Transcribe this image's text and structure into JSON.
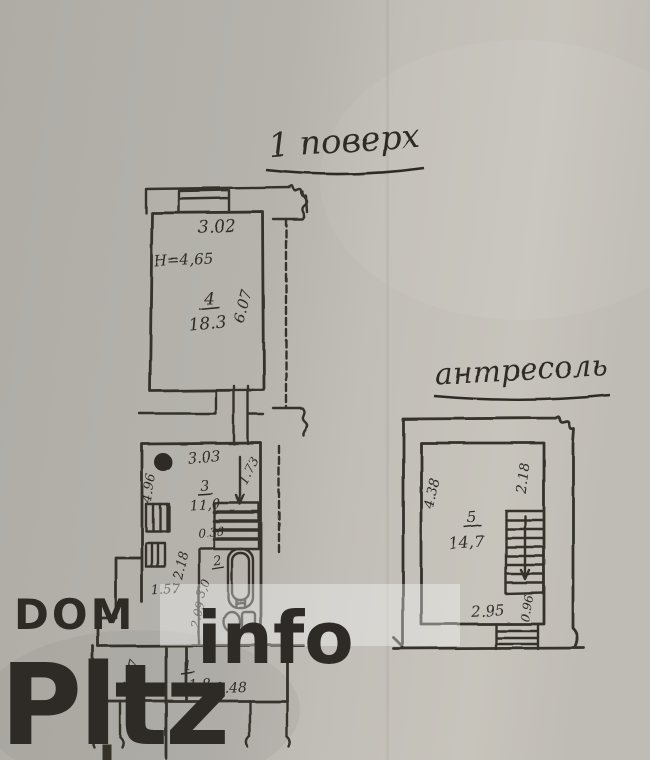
{
  "page": {
    "background": "#b6b3ad",
    "ink": "#35322c"
  },
  "titles": {
    "floor": "1 поверх",
    "mezzanine": "антресоль"
  },
  "floor1": {
    "room4": {
      "top_dim": "3.02",
      "height_note": "Н=4,65",
      "number": "4",
      "area": "18.3",
      "side_dim": "6.07"
    },
    "room3": {
      "top_dim": "3.03",
      "stair_dim": "1.73",
      "number": "3",
      "area": "11,0",
      "dim_a": "0.38",
      "dim_b": "2.18",
      "left_dim": "4.96",
      "niche_dim": "1.57"
    },
    "room2": {
      "number": "2",
      "area": "3,0",
      "side_dim": "2.09"
    },
    "room1": {
      "left_dim": "1.37",
      "number": "1",
      "area": "1,8",
      "bottom_dim": "3.48"
    }
  },
  "mezzanine": {
    "room5": {
      "left_dim": "4.38",
      "right_dim": "2.18",
      "number": "5",
      "area": "14,7",
      "bottom_dim": "2.95",
      "stair_dim": "0.96"
    }
  },
  "watermark": {
    "brand_top": "DOM",
    "brand_main": "Pltz",
    "brand_suffix": "info"
  }
}
